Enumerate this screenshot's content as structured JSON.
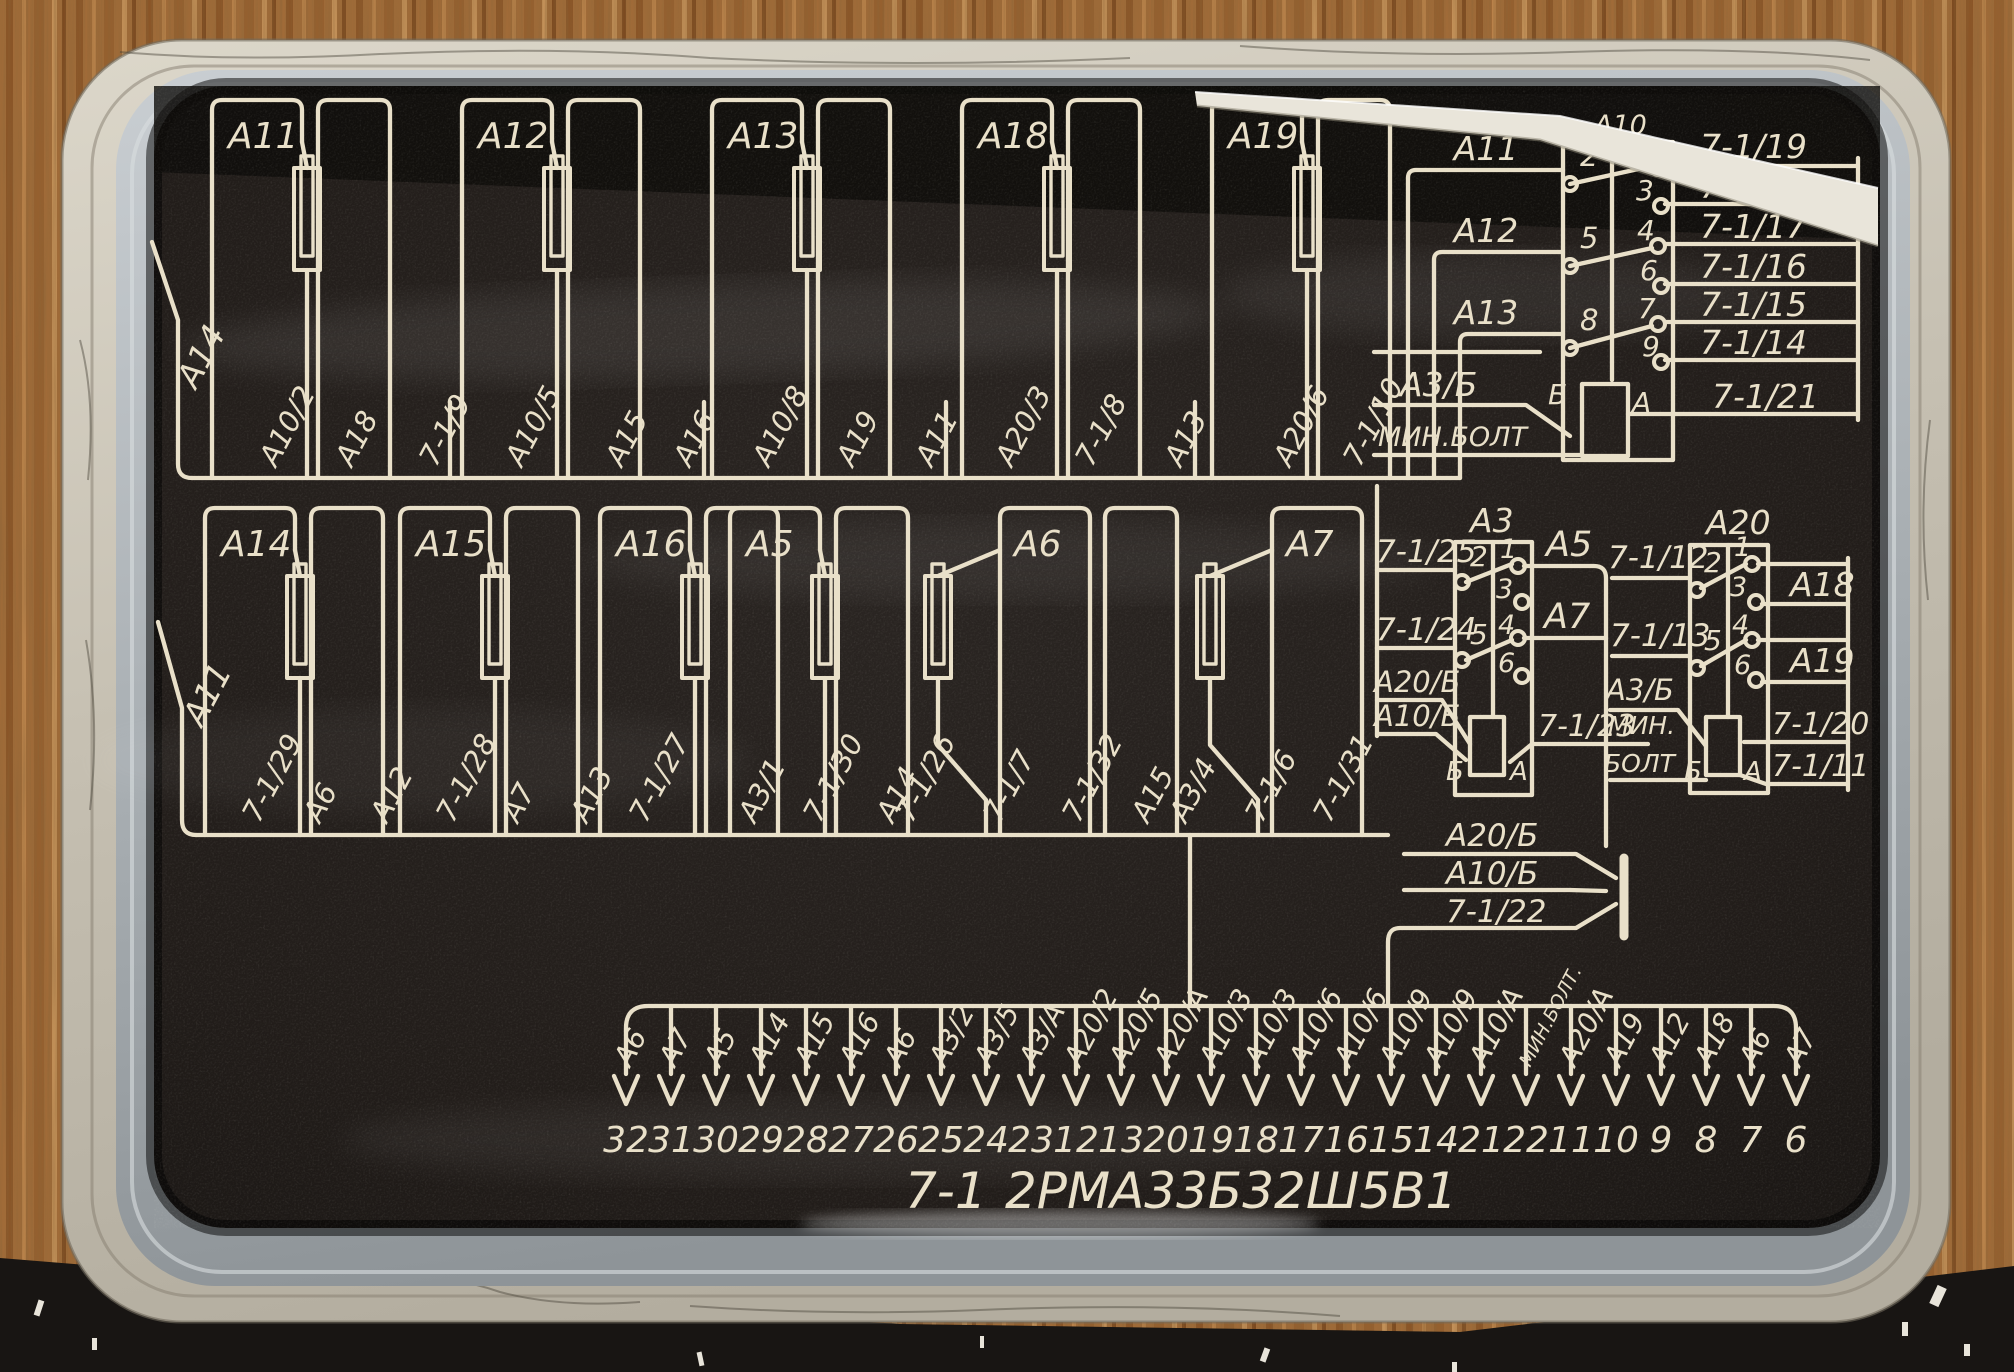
{
  "panel_title": {
    "prefix": "7-1",
    "designation": "2РМА33Б32Ш5В1"
  },
  "row1": {
    "edge_label": "А14",
    "units": [
      "А11",
      "А12",
      "А13",
      "А18",
      "А19"
    ],
    "wire_labels": [
      "А10/2",
      "А18",
      "7-1/9",
      "А10/5",
      "А15",
      "А16",
      "А10/8",
      "А19",
      "А11",
      "А20/3",
      "7-1/8",
      "А13",
      "А20/6",
      "7-1/10"
    ]
  },
  "row2": {
    "edge_label": "А11",
    "units": [
      "А14",
      "А15",
      "А16",
      "А5",
      "А6",
      "А7"
    ],
    "wire_labels": [
      "7-1/29",
      "А6",
      "А12",
      "7-1/28",
      "А7",
      "А13",
      "7-1/27",
      "А3/1",
      "7-1/30",
      "А14",
      "7-1/26",
      "7-1/7",
      "7-1/32",
      "А15",
      "А3/4",
      "7-1/6",
      "7-1/31"
    ]
  },
  "connector_a10": {
    "header": "А10",
    "inputs": [
      "А11",
      "А12",
      "А13"
    ],
    "input_bus_labels": [
      "А3/Б",
      "МИН.БОЛТ"
    ],
    "left_pins": [
      "2",
      "5",
      "8"
    ],
    "right_pins": [
      "1",
      "3",
      "4",
      "6",
      "7",
      "9"
    ],
    "coil_pins": [
      "Б",
      "А"
    ],
    "outputs": [
      "7-1/19",
      "7-1/18",
      "7-1/17",
      "7-1/16",
      "7-1/15",
      "7-1/14",
      "7-1/21"
    ]
  },
  "connector_a3": {
    "header": "А3",
    "inputs": [
      "7-1/25",
      "7-1/24",
      "А20/Б",
      "А10/Б"
    ],
    "left_pins": [
      "2",
      "5"
    ],
    "right_pins": [
      "1",
      "3",
      "4",
      "6"
    ],
    "coil_pins": [
      "Б",
      "А"
    ],
    "outputs": [
      "А5",
      "А7",
      "7-1/23"
    ]
  },
  "connector_a20": {
    "header": "А20",
    "inputs": [
      "7-1/12",
      "7-1/13",
      "А3/Б",
      "МИН.",
      "БОЛТ"
    ],
    "left_pins": [
      "2",
      "5"
    ],
    "right_pins": [
      "1",
      "3",
      "4",
      "6"
    ],
    "coil_pins": [
      "Б",
      "А"
    ],
    "outputs": [
      "А18",
      "А19",
      "7-1/20",
      "7-1/11"
    ]
  },
  "ground_group": {
    "labels": [
      "А20/Б",
      "А10/Б",
      "7-1/22"
    ]
  },
  "bottom_connector": {
    "pins": [
      {
        "wire": "А6",
        "pin": "32"
      },
      {
        "wire": "А7",
        "pin": "31"
      },
      {
        "wire": "А5",
        "pin": "30"
      },
      {
        "wire": "А14",
        "pin": "29"
      },
      {
        "wire": "А15",
        "pin": "28"
      },
      {
        "wire": "А16",
        "pin": "27"
      },
      {
        "wire": "А6",
        "pin": "26"
      },
      {
        "wire": "А3/2",
        "pin": "25"
      },
      {
        "wire": "А3/5",
        "pin": "24"
      },
      {
        "wire": "А3/А",
        "pin": "23"
      },
      {
        "wire": "А20/2",
        "pin": "12"
      },
      {
        "wire": "А20/5",
        "pin": "13"
      },
      {
        "wire": "А20/А",
        "pin": "20"
      },
      {
        "wire": "А10/3",
        "pin": "19"
      },
      {
        "wire": "А10/3",
        "pin": "18"
      },
      {
        "wire": "А10/6",
        "pin": "17"
      },
      {
        "wire": "А10/6",
        "pin": "16"
      },
      {
        "wire": "А10/9",
        "pin": "15"
      },
      {
        "wire": "А10/9",
        "pin": "14"
      },
      {
        "wire": "А10/А",
        "pin": "21"
      },
      {
        "wire": "МИН.БОЛТ.",
        "pin": "22"
      },
      {
        "wire": "А20/А",
        "pin": "11"
      },
      {
        "wire": "А19",
        "pin": "10"
      },
      {
        "wire": "А12",
        "pin": "9"
      },
      {
        "wire": "А18",
        "pin": "8"
      },
      {
        "wire": "А6",
        "pin": "7"
      },
      {
        "wire": "А7",
        "pin": "6"
      }
    ]
  },
  "colors": {
    "ink": "#e9e0c9",
    "panel": "#221d1a",
    "panel_dark_band": "#0e0c0a",
    "lid_metal": "#cdc7ba",
    "rim": "#aab0b4",
    "wood": "#a06b38",
    "mat": "#181513",
    "paper": "#e9e5da"
  }
}
